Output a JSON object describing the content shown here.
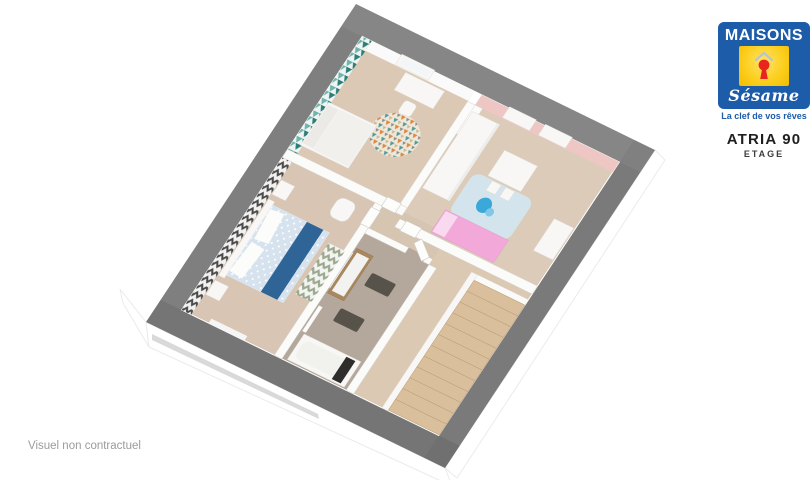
{
  "window": {
    "width": 811,
    "height": 480
  },
  "logo": {
    "brand_line1": "MAISONS",
    "brand_line2": "Sésame",
    "tagline": "La clef de vos rêves",
    "emblem": "keyhole-in-house-icon"
  },
  "plan_header": {
    "model": "ATRIA 90",
    "floor_label": "ETAGE"
  },
  "footer": {
    "disclaimer": "Visuel non contractuel"
  },
  "floorplan": {
    "type": "3d-floor-plan-cutaway",
    "view": "rotated axonometric, thick gray cut walls, white exterior facade below",
    "rooms": [
      {
        "id": "bedroom-2",
        "desc": "top bedroom: teal triangle wallpaper wall, window, white desk and stool, multicolor mosaic rug, white bed"
      },
      {
        "id": "bedroom-3",
        "desc": "child bedroom: pink wall with two windows, white wardrobe, play table with chairs, blue toy, light blue rug, pink bed, small dresser"
      },
      {
        "id": "bedroom-1",
        "desc": "master bedroom: dark patterned accent wall, double bed with blue runner, two nightstands, armchair, chevron rug"
      },
      {
        "id": "bathroom",
        "desc": "wood vanity with white basin, mirror, towel ladder, dark bath mats, bathtub along outer wall, open door"
      },
      {
        "id": "hallway",
        "desc": "central landing hallway with doors to every room"
      },
      {
        "id": "stair-landing",
        "desc": "landing with straight wooden staircase descending along the outer wall, white stringer rail"
      }
    ]
  },
  "colors": {
    "page_bg": "#ffffff",
    "brand_blue": "#1d5ca8",
    "brand_yellow": "#fccf1f",
    "brand_red": "#e8251f",
    "logo_caret": "#b9c4cc",
    "text_dark": "#1f1f1f",
    "text_medium": "#3c3c3c",
    "text_light": "#9b9b9b",
    "wall_gray": "#7f7f7f",
    "wall_white": "#fbfbfa",
    "wall_outline": "#d8d5d0",
    "floor_teal_room": "#dbc9b5",
    "floor_pink_room": "#dccbb8",
    "floor_master": "#d8c5b4",
    "floor_hall": "#d6c5b1",
    "floor_landing": "#dbc9b4",
    "floor_bath": "#b4a89c",
    "teal_dark": "#2e7d78",
    "teal_light": "#6fb5ae",
    "teal_bg": "#eef4f2",
    "scallop_dark": "#4a4a4a",
    "scallop_bg": "#f2f1ef",
    "pink_wall": "#eec7c5",
    "pink_bed": "#f2a9da",
    "pink_bed_light": "#f9d9ef",
    "bed_runner": "#2e6496",
    "bedding": "#d6e3ee",
    "rug_blue": "#d3e4ec",
    "chevron": "#9aa88f",
    "rug_bg": "#f3f3ef",
    "mosaic_orange": "#d98a3f",
    "mosaic_teal": "#4e9d96",
    "mosaic_gray": "#8c8c8c",
    "mosaic_bg": "#efe7da",
    "wood_vanity": "#a9885f",
    "mat_dark": "#57534b",
    "stair_wood": "#d9bf9b",
    "stair_edge": "#b99b76",
    "toy_blue": "#3aa8d8",
    "facade_shadow": "#b9b9b9"
  }
}
